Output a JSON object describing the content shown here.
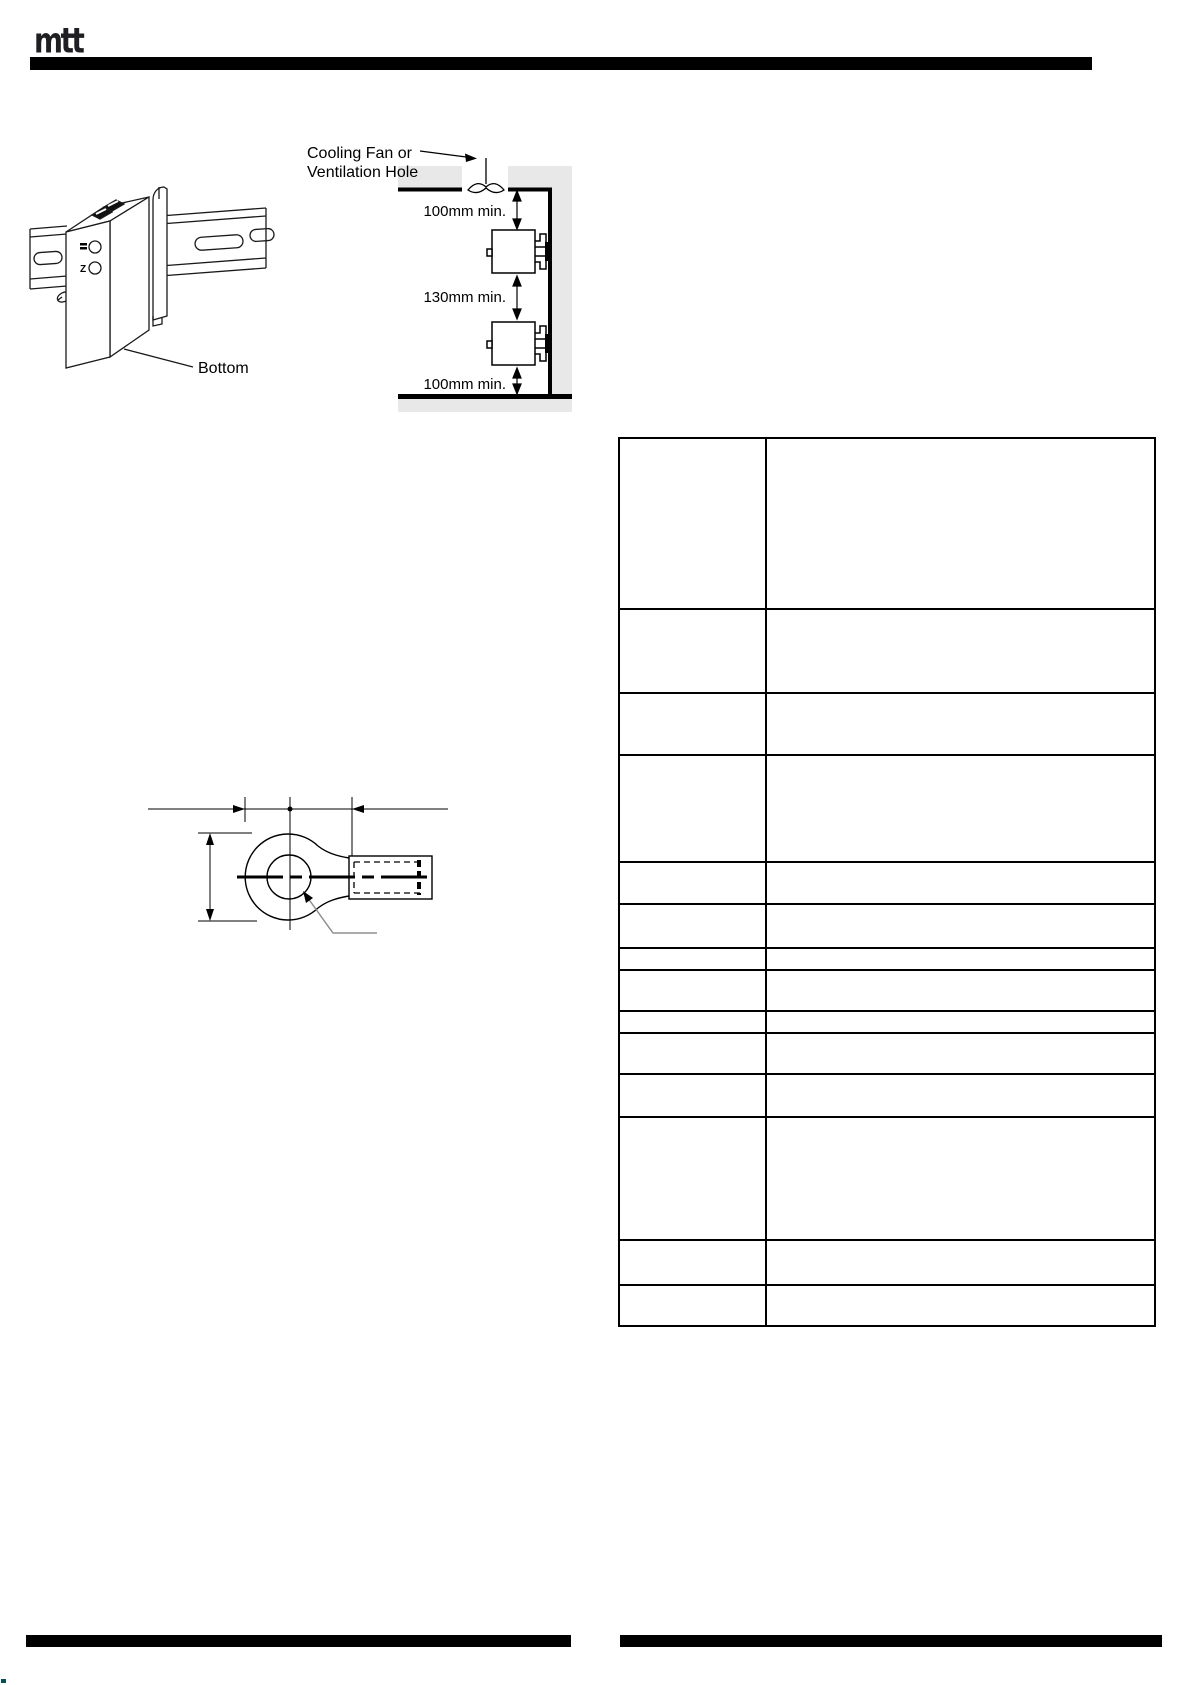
{
  "logo": {
    "text": "mtt"
  },
  "figures": {
    "din_rail": {
      "caption": "Bottom",
      "led_label_bottom": "Z"
    },
    "clearance": {
      "callout_line1": "Cooling Fan or",
      "callout_line2": "Ventilation Hole",
      "dim_top": "100mm min.",
      "dim_middle": "130mm min.",
      "dim_bottom": "100mm min."
    }
  },
  "spec_table": {
    "rows": [
      {
        "label": "",
        "value": ""
      },
      {
        "label": "",
        "value": ""
      },
      {
        "label": "",
        "value": ""
      },
      {
        "label": "",
        "value": ""
      },
      {
        "label": "",
        "value": ""
      },
      {
        "label": "",
        "value": ""
      },
      {
        "label": "",
        "value": ""
      },
      {
        "label": "",
        "value": ""
      },
      {
        "label": "",
        "value": ""
      },
      {
        "label": "",
        "value": ""
      },
      {
        "label": "",
        "value": ""
      },
      {
        "label": "",
        "value": ""
      },
      {
        "label": "",
        "value": ""
      },
      {
        "label": "",
        "value": ""
      }
    ]
  },
  "colors": {
    "rule_black": "#000000",
    "wall_gray": "#e8e8e8",
    "leader_gray": "#8f8f8f"
  }
}
